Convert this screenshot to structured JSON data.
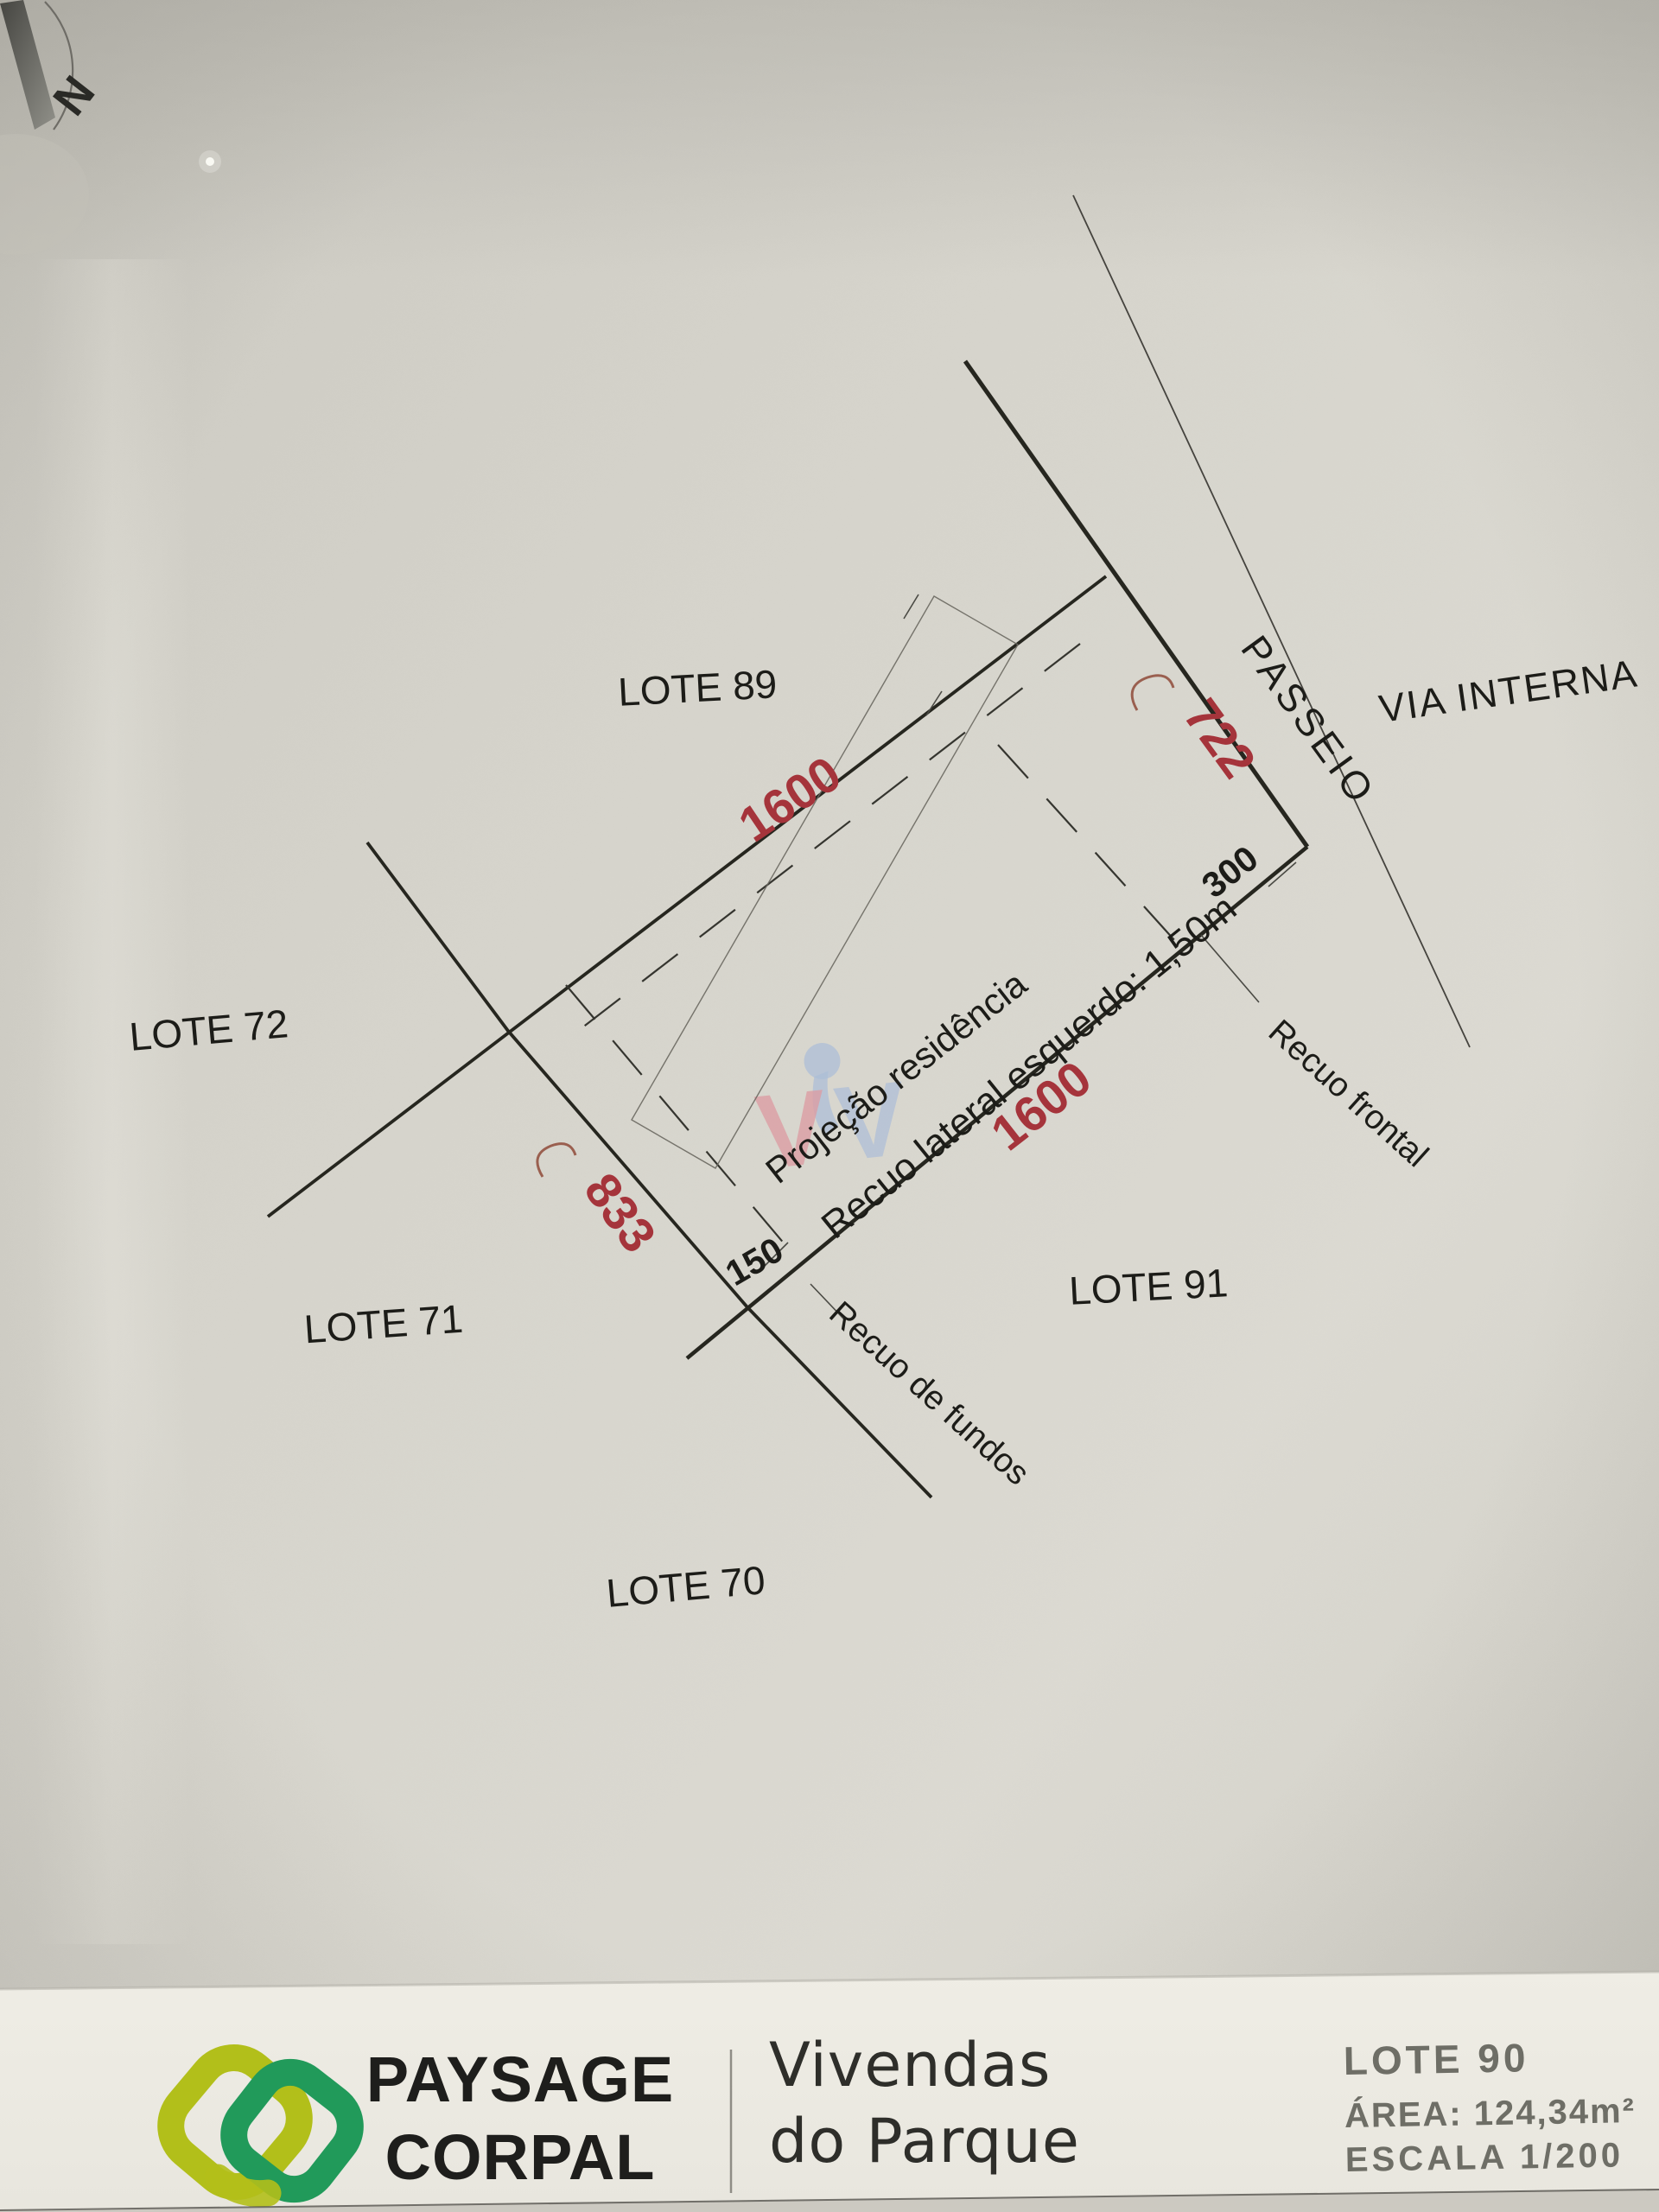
{
  "plan": {
    "compass_n": "N",
    "lots": {
      "lot89": "LOTE 89",
      "lot72": "LOTE 72",
      "lot71": "LOTE 71",
      "lot70": "LOTE 70",
      "lot91": "LOTE 91"
    },
    "streets": {
      "passeio": "PASSEIO",
      "via_interna": "VIA INTERNA"
    },
    "dimensions": {
      "side_top": "1600",
      "side_right": "1600",
      "front": "722",
      "back": "833",
      "recuo_frontal_dim": "300",
      "recuo_fundos_dim": "150"
    },
    "annotations": {
      "projecao": "Projeção residência",
      "recuo_lateral": "Recuo lateral esquerdo: 1,50m",
      "recuo_frontal": "Recuo frontal",
      "recuo_fundos": "Recuo de fundos"
    },
    "colors": {
      "dimension_red": "#a5343b",
      "line_black": "#26261f"
    }
  },
  "watermark": {
    "letter_v_pink": "V",
    "letter_v_blue": "V"
  },
  "footer": {
    "brand_line1": "PAYSAGE",
    "brand_line2": "CORPAL",
    "project_line1": "Vivendas",
    "project_line2": "do Parque",
    "lot_title": "LOTE 90",
    "area": "ÁREA: 124,34m²",
    "scale": "ESCALA 1/200",
    "logo_colors": {
      "left_link": "#b2bf1a",
      "right_link": "#219a5a"
    }
  }
}
